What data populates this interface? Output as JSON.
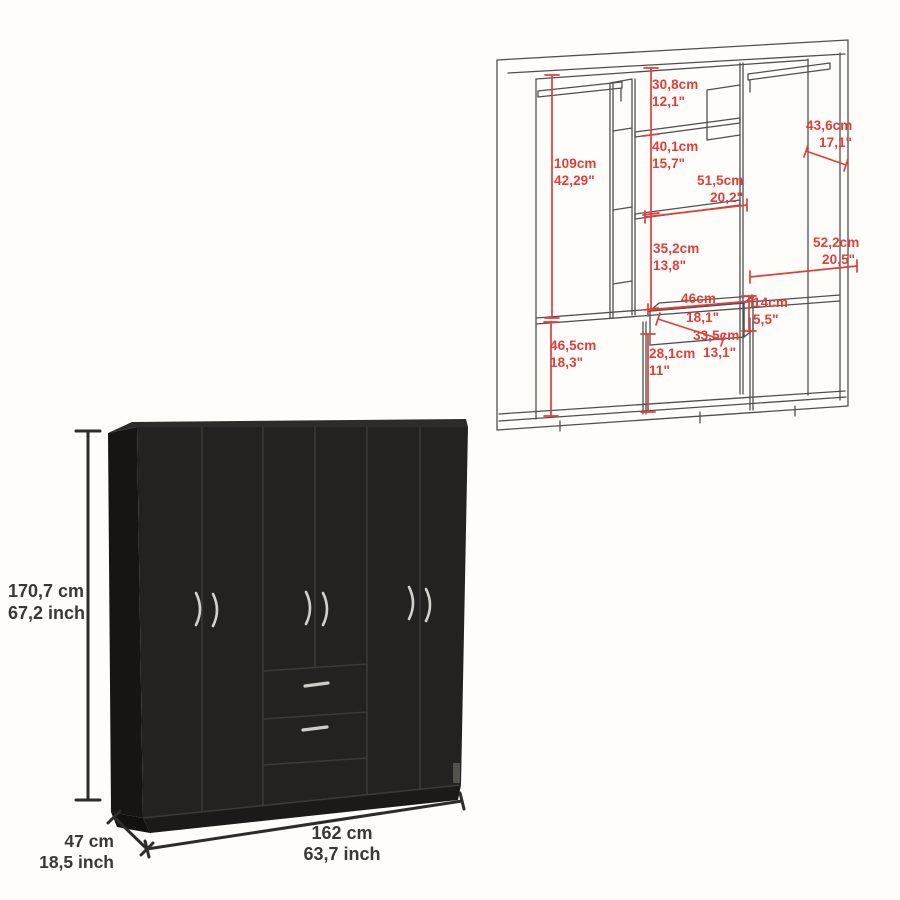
{
  "background_color": "#fffdfa",
  "accent_red": "#e03e3a",
  "line_gray": "#4f4f4f",
  "wardrobe_black": "#242220",
  "interior": {
    "dims": [
      {
        "name": "top-center-section-height",
        "cm": "30,8cm",
        "inch": "12,1\""
      },
      {
        "name": "second-center-section-height",
        "cm": "40,1cm",
        "inch": "15,7\""
      },
      {
        "name": "right-side-depth",
        "cm": "43,6cm",
        "inch": "17,1\""
      },
      {
        "name": "left-column-height",
        "cm": "109cm",
        "inch": "42,29\""
      },
      {
        "name": "center-shelf-width",
        "cm": "51,5cm",
        "inch": "20,2\""
      },
      {
        "name": "third-center-section-height",
        "cm": "35,2cm",
        "inch": "13,8\""
      },
      {
        "name": "right-column-width",
        "cm": "52,2cm",
        "inch": "20,5\""
      },
      {
        "name": "drawer-width",
        "cm": "46cm",
        "inch": "18,1\""
      },
      {
        "name": "drawer-height",
        "cm": "14cm",
        "inch": "5,5\""
      },
      {
        "name": "drawer-depth",
        "cm": "33,5cm",
        "inch": "13,1\""
      },
      {
        "name": "bottom-left-section-height",
        "cm": "46,5cm",
        "inch": "18,3\""
      },
      {
        "name": "bottom-center-section-height",
        "cm": "28,1cm",
        "inch": "11\""
      }
    ]
  },
  "exterior": {
    "height": {
      "cm": "170,7 cm",
      "inch": "67,2 inch"
    },
    "depth": {
      "cm": "47 cm",
      "inch": "18,5 inch"
    },
    "width": {
      "cm": "162 cm",
      "inch": "63,7 inch"
    }
  }
}
